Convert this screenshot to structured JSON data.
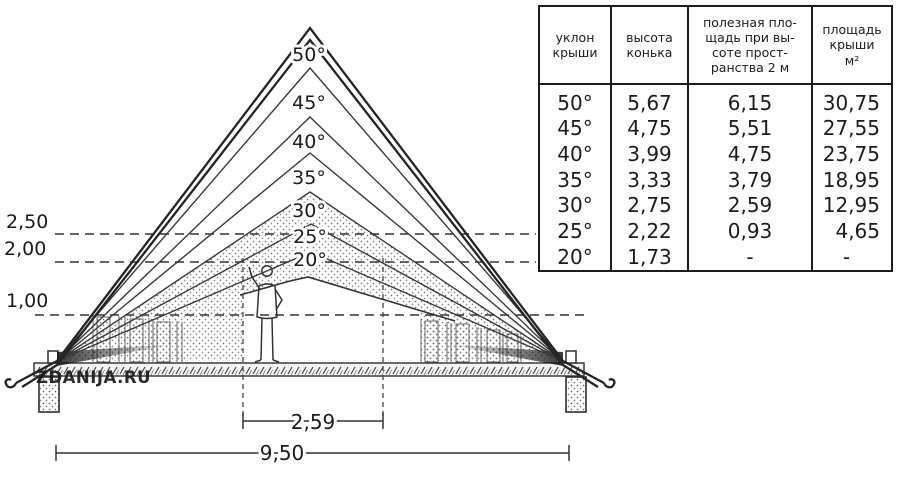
{
  "diagram": {
    "watermark": "ZDANIJA.RU",
    "angle_labels": [
      "50°",
      "45°",
      "40°",
      "35°",
      "30°",
      "25°",
      "20°"
    ],
    "height_marks": [
      "2,50",
      "2,00",
      "1,00"
    ],
    "inner_width": "2,59",
    "total_width": "9,50"
  },
  "table": {
    "headers": [
      "уклон\nкрыши",
      "высота\nконька",
      "полезная пло-\nщадь при вы-\nсоте прост-\nранства 2 м",
      "площадь\nкрыши\nм²"
    ],
    "rows": [
      [
        "50°",
        "5,67",
        "6,15",
        "30,75"
      ],
      [
        "45°",
        "4,75",
        "5,51",
        "27,55"
      ],
      [
        "40°",
        "3,99",
        "4,75",
        "23,75"
      ],
      [
        "35°",
        "3,33",
        "3,79",
        "18,95"
      ],
      [
        "30°",
        "2,75",
        "2,59",
        "12,95"
      ],
      [
        "25°",
        "2,22",
        "0,93",
        "4,65"
      ],
      [
        "20°",
        "1,73",
        "-",
        "-"
      ]
    ]
  }
}
